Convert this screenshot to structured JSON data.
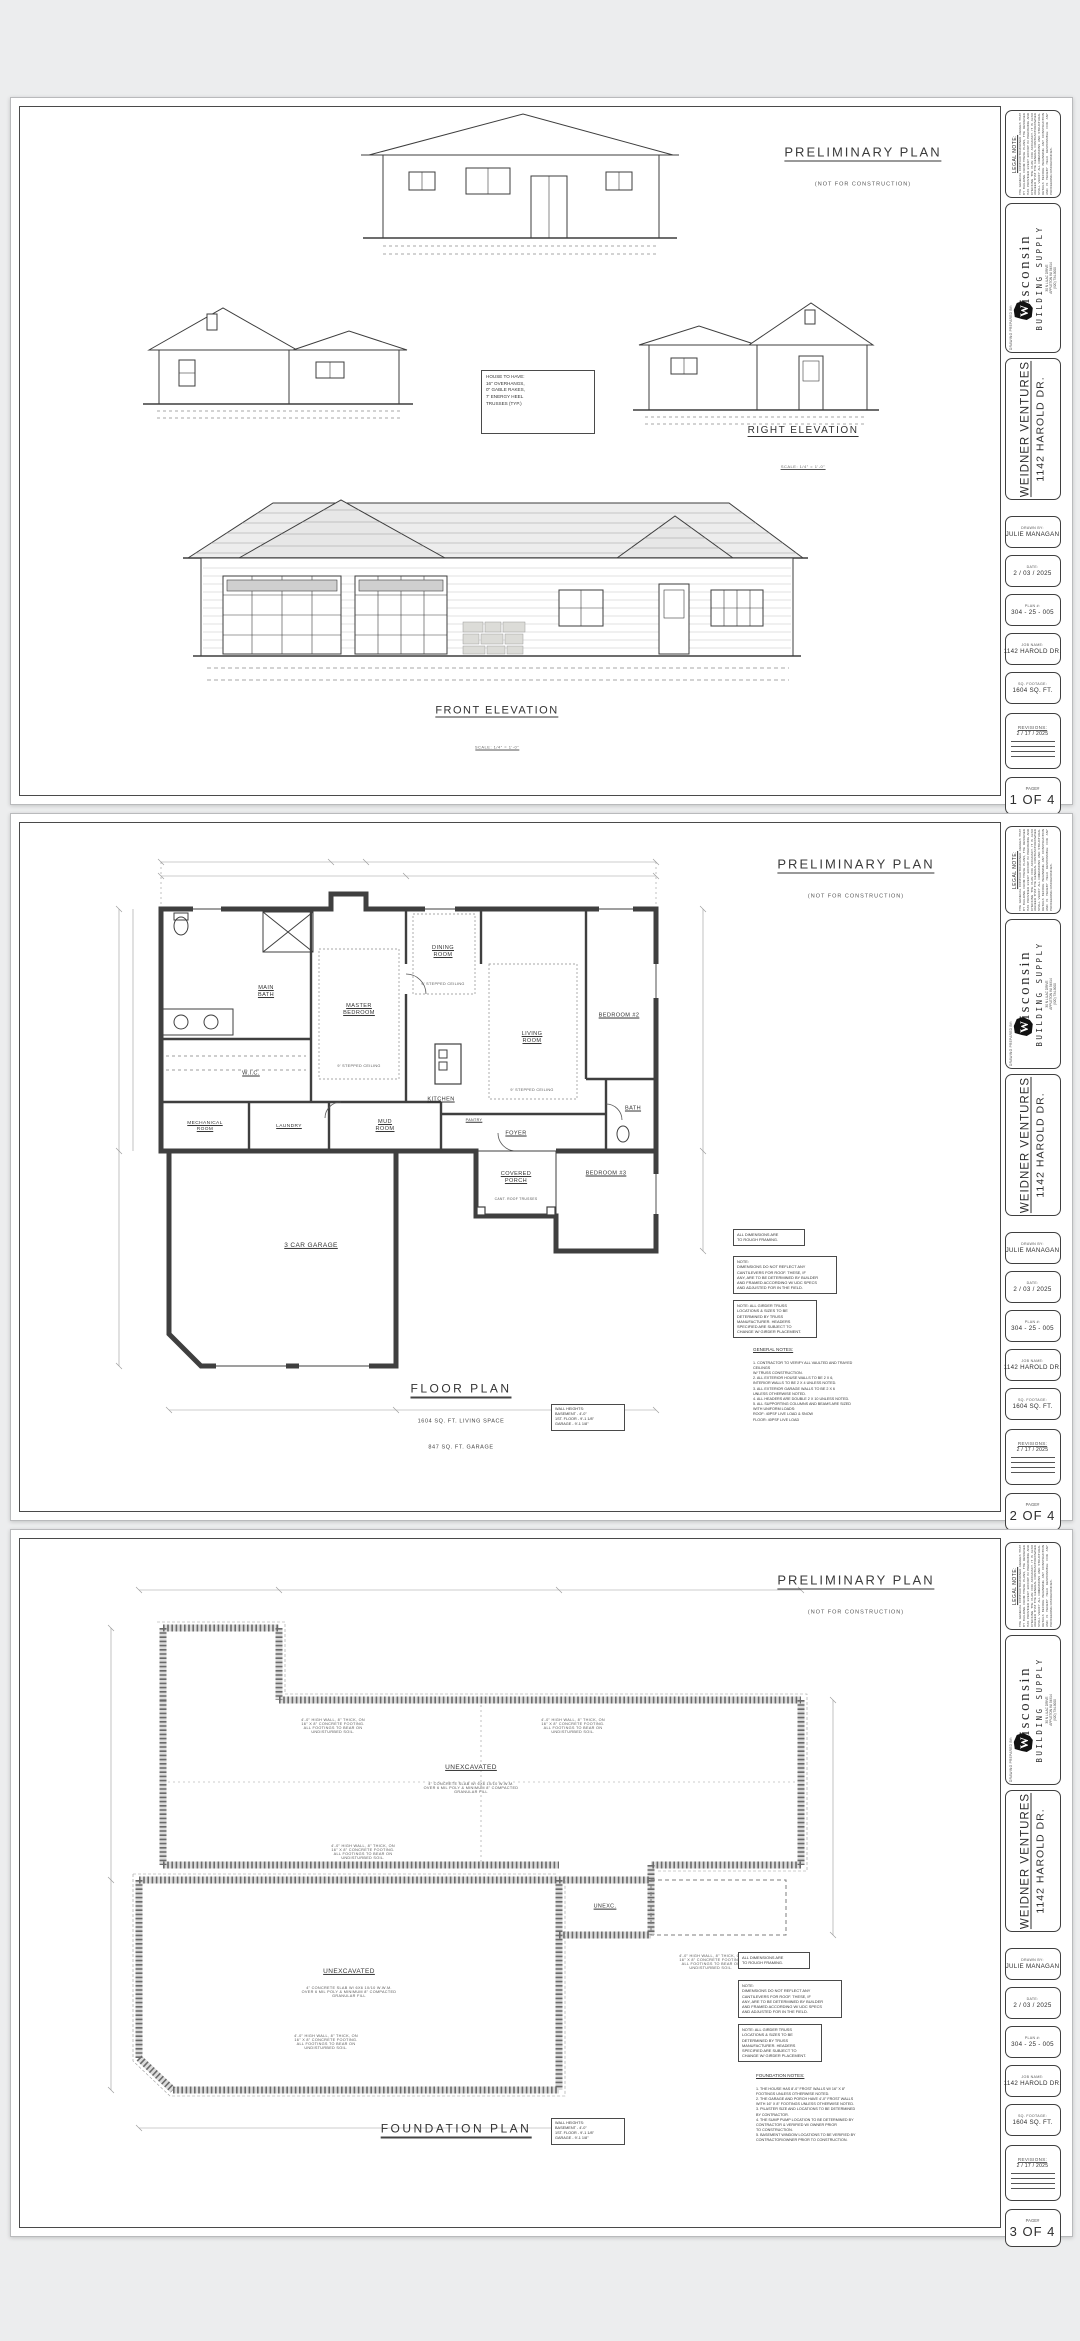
{
  "title_block": {
    "legal_note_title": "LEGAL NOTE:",
    "legal_note_body": "THE GENERAL CONTRACTOR/OWNER AGREES THAT BY BUILDING FROM THESE PLANS, THE DESIGNER HAS PROVIDED EVERY EFFORT IN PREPARING AND CHECKING THE PLAN FOR ACCURACY. IT IS ALSO AGREED THAT THE GENERAL CONTRACTOR/OWNER SHALL VERIFY ALL DIMENSIONS AND STRUCTURAL DETAILS BEFORE BEGINNING ANY CONSTRUCTION AND IS HEREBY HELD RESPONSIBLE FOR ANY PROCEEDING DISCREPANCIES.",
    "prepared_by_label": "DRAWING PREPARED BY:",
    "brand_w": "W",
    "brand_name": "isconsin",
    "brand_sub": "BUILDING SUPPLY",
    "brand_addr": "30 N LILAC DRIVE\nAPPLETON WI 54914\n(920) 734-9000",
    "client_name": "WEIDNER VENTURES",
    "client_addr": "1142 HAROLD DR.",
    "drawn_by_label": "DRAWN BY:",
    "drawn_by": "JULIE MANAGAN",
    "date_label": "DATE:",
    "date": "2 / 03 / 2025",
    "plan_label": "PLAN #:",
    "plan_number": "304 - 25 - 005",
    "job_label": "JOB NAME:",
    "job_name": "1142 HAROLD DR.",
    "sqft_label": "SQ. FOOTAGE:",
    "sqft": "1604 SQ. FT.",
    "revisions_label": "REVISIONS:",
    "revision_1": "2 / 17 / 2025",
    "page_label": "PAGE#"
  },
  "stamp": {
    "title": "PRELIMINARY PLAN",
    "sub": "(NOT FOR CONSTRUCTION)"
  },
  "scale_note": "SCALE: 1/4\" = 1'-0\"",
  "sheets": [
    {
      "page": "1 OF 4",
      "house_note": "HOUSE TO HAVE:\n  16\" OVERHANGS,\n  0\" GABLE RAKES,\n  7' ENERGY HEEL\n  TRUSSES (TYP.)",
      "labels": {
        "right_elevation": "RIGHT ELEVATION",
        "front_elevation": "FRONT ELEVATION"
      }
    },
    {
      "page": "2 OF 4",
      "title": "FLOOR PLAN",
      "subtitle1": "1604 SQ. FT. LIVING SPACE",
      "subtitle2": "847 SQ. FT. GARAGE",
      "wall_heights": "WALL HEIGHTS:\nBASEMENT  - 4'-0\"\n1ST. FLOOR - 9'-1 1/8\"\nGARAGE    - 9'-1 1/8\"",
      "rooms": {
        "main_bath": "MAIN\nBATH",
        "wic": "W.I.C.",
        "mechanical": "MECHANICAL\nROOM",
        "laundry": "LAUNDRY",
        "mud": "MUD\nROOM",
        "master": "MASTER\nBEDROOM",
        "dining": "DINING\nROOM",
        "kitchen": "KITCHEN",
        "pantry": "PANTRY",
        "living": "LIVING\nROOM",
        "bedroom2": "BEDROOM #2",
        "bedroom3": "BEDROOM #3",
        "bath": "BATH",
        "foyer": "FOYER",
        "porch": "COVERED\nPORCH",
        "porch_note": "CANT. ROOF TRUSSES",
        "garage": "3 CAR GARAGE",
        "stepped_ceiling": "9' STEPPED CEILING"
      },
      "notes": {
        "dims": "ALL DIMENSIONS ARE\nTO ROUGH FRAMING.",
        "cantilever": "NOTE:\nDIMENSIONS DO NOT REFLECT ANY\nCANTILEVERS FOR ROOF.  THESE, IF\nANY, ARE TO BE DETERMINED BY BUILDER\nAND FRAMED ACCORDING W/ UDC SPECS\nAND ADJUSTED FOR IN THE FIELD.",
        "girder": "NOTE:  ALL GIRDER TRUSS\nLOCATIONS & SIZES TO BE\nDETERMINED BY TRUSS\nMANUFACTURER.  HEADERS\nSPECIFIED ARE SUBJECT TO\nCHANGE W/ GIRDER PLACEMENT.",
        "general_title": "GENERAL NOTES:",
        "general_body": "1.  CONTRACTOR TO VERIFY ALL VAULTED AND TRAYED CEILINGS\n     W/ TRUSS CONSTRUCTION.\n2.  ALL EXTERIOR HOUSE WALLS TO BE 2 X 6,\n     INTERIOR WALLS TO BE 2 X 4 UNLESS NOTED.\n3.  ALL EXTERIOR GARAGE WALLS TO BE 2 X 6\n     UNLESS OTHERWISE NOTED.\n4.  ALL HEADERS ARE DOUBLE 2 X 10 UNLESS NOTED.\n5.  ALL SUPPORTING COLUMNS AND BEAMS ARE SIZED\n     WITH UNIFORM LOADS:\n     ROOF:  40PSF LIVE LOAD & SNOW\n     FLOOR: 40PSF LIVE LOAD"
      }
    },
    {
      "page": "3 OF 4",
      "title": "FOUNDATION PLAN",
      "wall_heights": "WALL HEIGHTS:\nBASEMENT  - 4'-0\"\n1ST. FLOOR - 9'-1 1/8\"\nGARAGE    - 9'-1 1/8\"",
      "labels": {
        "unexcavated": "UNEXCAVATED",
        "slab_note": "4\" CONCRETE SLAB W/ 6X6 10/10 W.W.M.\nOVER 6 MIL POLY & MINIMUM 8\" COMPACTED\nGRANULAR FILL",
        "unexc_small": "UNEXC.",
        "wall_note": "4'-0\" HIGH WALL, 8\" THICK, ON\n16\" X 8\" CONCRETE FOOTING.\nALL FOOTINGS TO BEAR ON\nUNDISTURBED SOIL."
      },
      "notes": {
        "dims": "ALL DIMENSIONS ARE\nTO ROUGH FRAMING.",
        "cantilever": "NOTE:\nDIMENSIONS DO NOT REFLECT ANY\nCANTILEVERS FOR ROOF.  THESE, IF\nANY, ARE TO BE DETERMINED BY BUILDER\nAND FRAMED ACCORDING W/ UDC SPECS\nAND ADJUSTED FOR IN THE FIELD.",
        "girder": "NOTE:  ALL GIRDER TRUSS\nLOCATIONS & SIZES TO BE\nDETERMINED BY TRUSS\nMANUFACTURER.  HEADERS\nSPECIFIED ARE SUBJECT TO\nCHANGE W/ GIRDER PLACEMENT.",
        "foundation_title": "FOUNDATION NOTES:",
        "foundation_body": "1.  THE HOUSE HAS 8'-0\" FROST WALLS W/ 16\" X 8\"\n     FOOTINGS UNLESS OTHERWISE NOTED.\n2.  THE GARAGE AND PORCH HAVE 4'-0\" FROST WALLS\n     WITH 16\" X 8\" FOOTINGS UNLESS OTHERWISE NOTED.\n3.  PILASTER SIZE AND LOCATIONS TO BE DETERMINED\n     BY CONTRACTOR.\n4.  THE SUMP PUMP LOCATION TO BE DETERMINED BY\n     CONTRACTOR & VERIFIED W/ OWNER PRIOR\n     TO CONSTRUCTION.\n5.  BASEMENT WINDOW LOCATIONS TO BE VERIFIED BY\n     CONTRACTOR/OWNER PRIOR TO CONSTRUCTION."
      }
    }
  ]
}
